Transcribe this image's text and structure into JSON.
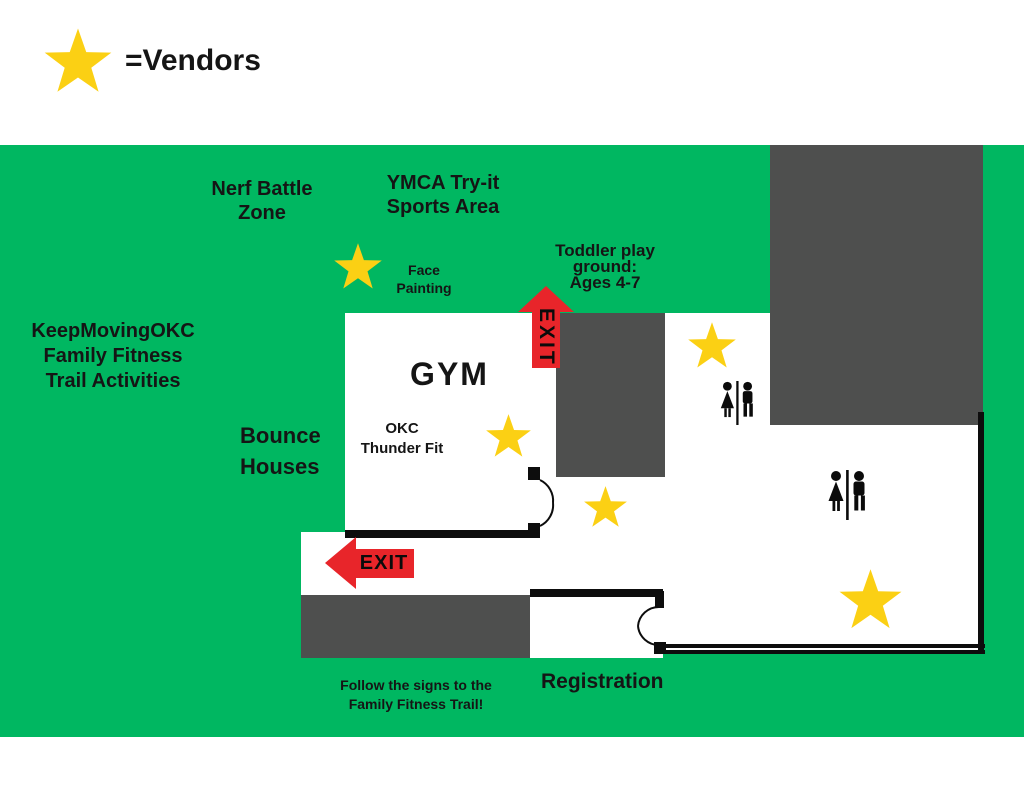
{
  "colors": {
    "map-green": "#00B761",
    "block-gray": "#4E4F4E",
    "star-yellow": "#FBD014",
    "exit-red": "#E8252A",
    "wall-black": "#0D0D0D",
    "ink": "#151515"
  },
  "legend": {
    "star_icon": "star-icon",
    "label": "=Vendors"
  },
  "map": {
    "zones": {
      "nerf_battle": "Nerf Battle\nZone",
      "ymca_try_it": "YMCA Try-it\nSports Area",
      "toddler_playground": "Toddler play\nground:\nAges 4-7",
      "keep_moving_okc": "KeepMovingOKC\nFamily Fitness\nTrail Activities",
      "face_painting": "Face\nPainting",
      "bounce_houses": "Bounce\nHouses",
      "gym": "GYM",
      "okc_thunder_fit": "OKC\nThunder Fit",
      "registration": "Registration",
      "follow_signs": "Follow the signs to the\nFamily Fitness Trail!"
    },
    "exit_up_label": "EXIT",
    "exit_left_label": "EXIT",
    "vendor_star_count_on_map": 5,
    "restroom_count": 2,
    "door_count": 2
  }
}
